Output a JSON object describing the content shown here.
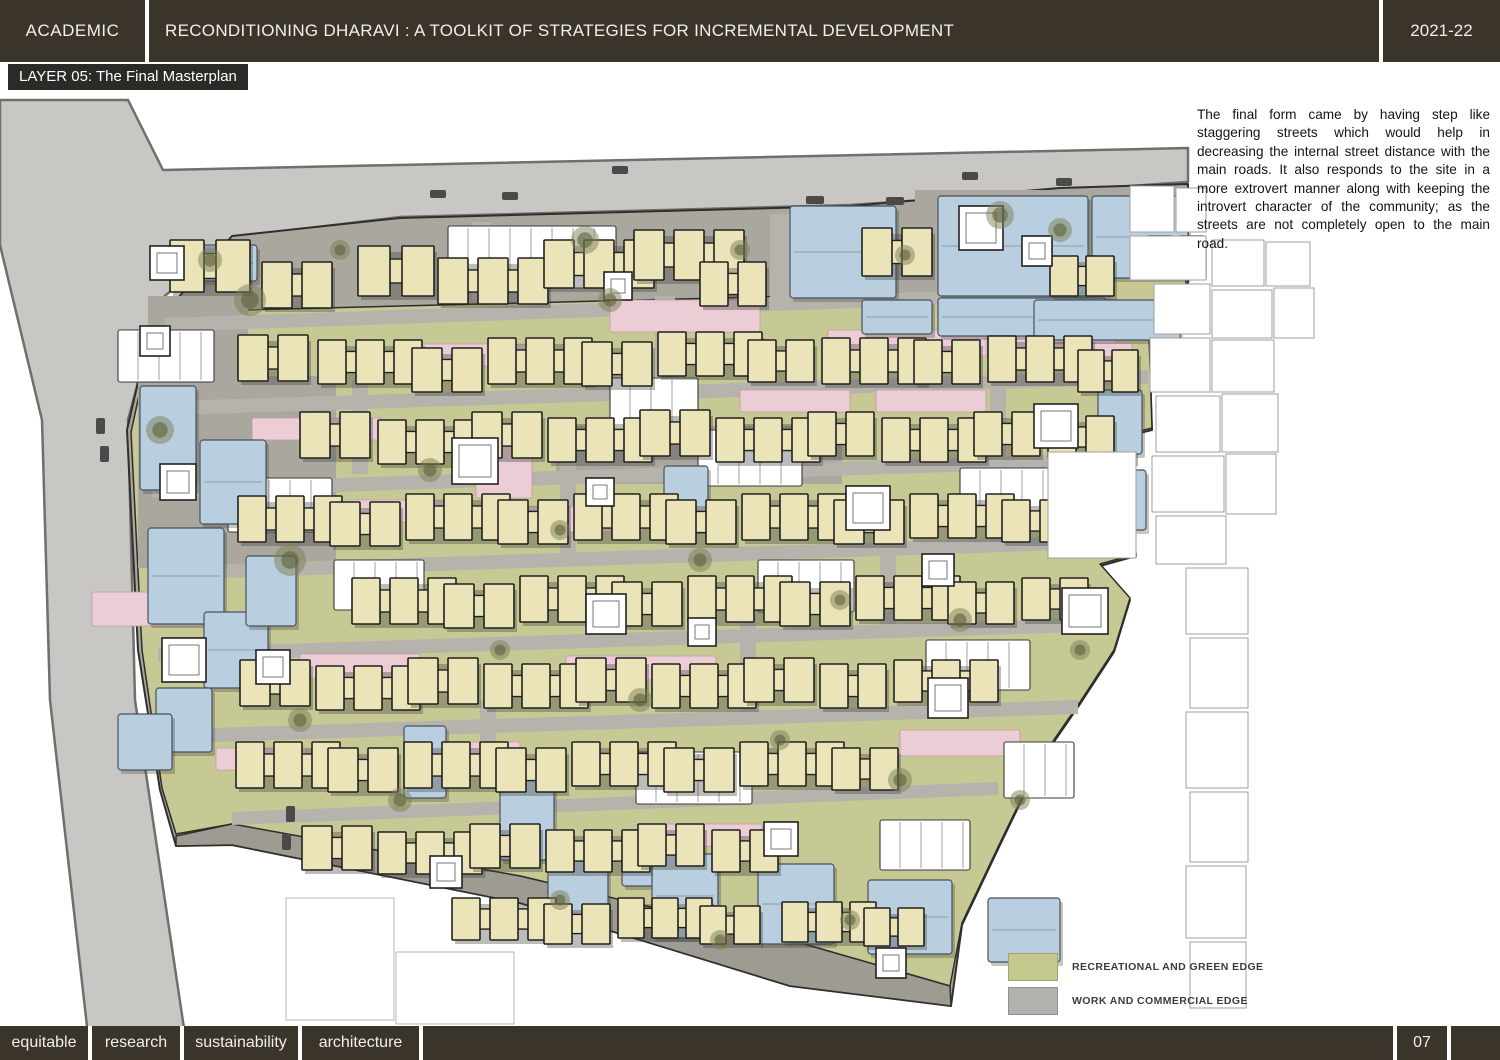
{
  "header": {
    "left": "ACADEMIC",
    "title": "RECONDITIONING DHARAVI : A TOOLKIT OF STRATEGIES FOR INCREMENTAL DEVELOPMENT",
    "right": "2021-22"
  },
  "layer_label": "LAYER 05: The Final Masterplan",
  "description": "The final form came by having step like staggering streets which would help in decreasing the internal street distance with the main roads. It also responds to the site in a more extrovert manner along with keeping the introvert character of the community; as the streets are not completely open to the main road.",
  "legend": {
    "items": [
      {
        "label": "RECREATIONAL AND GREEN EDGE",
        "color": "#c6c98d"
      },
      {
        "label": "WORK AND COMMERCIAL EDGE",
        "color": "#b2b1ad"
      }
    ]
  },
  "footer": {
    "tags": [
      "equitable",
      "research",
      "sustainability",
      "architecture"
    ],
    "page": "07"
  },
  "map": {
    "colors": {
      "road": "#c8c7c4",
      "roadEdge": "#6f6f6d",
      "siteGray": "#aaa79f",
      "siteEdge": "#2f2f2d",
      "bottomBand": "#9e9b93",
      "green": "#c7c995",
      "greenEdge": "#2c2c2a",
      "street": "#b6b3ac",
      "cream": "#ebe4b9",
      "creamEdge": "#22211e",
      "pink": "#eccdd6",
      "pinkEdge": "#c09aa6",
      "blue": "#b9cfe0",
      "blueEdge": "#46525c",
      "white": "#ffffff",
      "whiteEdge": "#3a3a3a",
      "context": "#9f9f9f",
      "contextLight": "#b8b8b8",
      "tree": "#7b7f53",
      "treeDark": "#5d6140",
      "car": "#4a4a48",
      "shadow": "#3f3e39"
    },
    "road_polygon": "0,100 128,100 163,170 1188,148 1188,182 850,205 400,217 235,237 160,300 128,420 135,700 185,1035 88,1035 50,700 42,420 0,245",
    "site_polygon": "232,236 400,218 850,206 1060,188 1188,184 1188,300 1148,308 1152,430 1120,438 1136,556 1100,566 1130,600 1114,652 1080,704 1040,762 1000,845 962,925 951,1006 790,986 520,903 232,845 176,846 160,790 138,650 127,430 150,330",
    "green_polygon": "165,312 1035,290 1038,215 1120,206 1186,202 1186,296 1148,304 1152,428 1120,436 1136,554 1100,564 1130,598 1114,650 1080,702 1040,760 1000,843 962,923 950,986 790,940 520,876 232,824 176,834 162,788 142,650 131,432 152,336",
    "bottom_band": "176,836 232,824 520,876 790,940 950,986 951,1006 790,986 520,903 232,845 176,846",
    "gray_plazas": [
      [
        138,
        376,
        198,
        192
      ],
      [
        915,
        190,
        196,
        112
      ],
      [
        148,
        296,
        100,
        110
      ],
      [
        556,
        426,
        286,
        58
      ]
    ],
    "streets": [
      [
        165,
        318,
        1035,
        288,
        14
      ],
      [
        142,
        402,
        1148,
        370,
        14
      ],
      [
        152,
        484,
        1138,
        452,
        14
      ],
      [
        166,
        566,
        1125,
        534,
        14
      ],
      [
        158,
        648,
        1108,
        617,
        14
      ],
      [
        152,
        730,
        1078,
        700,
        14
      ],
      [
        232,
        812,
        998,
        782,
        13
      ]
    ],
    "vstreets": [
      [
        472,
        222,
        18,
        80
      ],
      [
        655,
        296,
        20,
        94
      ],
      [
        770,
        214,
        22,
        96
      ],
      [
        352,
        380,
        16,
        94
      ],
      [
        560,
        462,
        16,
        94
      ],
      [
        880,
        534,
        16,
        98
      ],
      [
        740,
        617,
        16,
        94
      ],
      [
        480,
        700,
        16,
        86
      ],
      [
        900,
        296,
        18,
        80
      ],
      [
        990,
        380,
        16,
        86
      ]
    ],
    "green_patches": [
      [
        975,
        212,
        28,
        74
      ],
      [
        956,
        246,
        66,
        20
      ]
    ],
    "pinks": [
      [
        610,
        300,
        150,
        32
      ],
      [
        828,
        330,
        180,
        26
      ],
      [
        986,
        330,
        130,
        26
      ],
      [
        404,
        344,
        130,
        22
      ],
      [
        252,
        418,
        130,
        22
      ],
      [
        476,
        428,
        56,
        70
      ],
      [
        504,
        506,
        140,
        26
      ],
      [
        92,
        592,
        108,
        34
      ],
      [
        300,
        654,
        120,
        24
      ],
      [
        566,
        656,
        150,
        24
      ],
      [
        1082,
        343,
        50,
        40
      ],
      [
        740,
        390,
        110,
        22
      ],
      [
        876,
        390,
        110,
        22
      ],
      [
        348,
        500,
        100,
        22
      ],
      [
        900,
        730,
        120,
        26
      ],
      [
        216,
        748,
        90,
        22
      ],
      [
        652,
        824,
        110,
        22
      ],
      [
        420,
        742,
        100,
        22
      ]
    ],
    "whites": [
      [
        448,
        226,
        168,
        62
      ],
      [
        118,
        330,
        96,
        52
      ],
      [
        610,
        378,
        88,
        52
      ],
      [
        698,
        430,
        104,
        56
      ],
      [
        228,
        478,
        104,
        54
      ],
      [
        926,
        640,
        104,
        50
      ],
      [
        636,
        752,
        116,
        52
      ],
      [
        880,
        820,
        90,
        50
      ],
      [
        1004,
        742,
        70,
        56
      ],
      [
        334,
        560,
        90,
        50
      ],
      [
        758,
        560,
        96,
        52
      ],
      [
        960,
        468,
        90,
        52
      ]
    ],
    "blues": [
      [
        938,
        196,
        150,
        100
      ],
      [
        1092,
        196,
        96,
        82
      ],
      [
        938,
        298,
        168,
        38
      ],
      [
        1034,
        300,
        146,
        40
      ],
      [
        790,
        206,
        106,
        92
      ],
      [
        862,
        300,
        70,
        34
      ],
      [
        1098,
        390,
        44,
        64
      ],
      [
        1106,
        470,
        40,
        60
      ],
      [
        140,
        386,
        56,
        104
      ],
      [
        200,
        440,
        66,
        84
      ],
      [
        148,
        528,
        76,
        96
      ],
      [
        204,
        612,
        64,
        76
      ],
      [
        156,
        688,
        56,
        64
      ],
      [
        246,
        556,
        50,
        70
      ],
      [
        664,
        466,
        44,
        64
      ],
      [
        622,
        830,
        40,
        56
      ],
      [
        652,
        854,
        66,
        84
      ],
      [
        758,
        864,
        76,
        80
      ],
      [
        868,
        880,
        84,
        74
      ],
      [
        988,
        898,
        72,
        64
      ],
      [
        548,
        846,
        60,
        74
      ],
      [
        500,
        776,
        54,
        84
      ],
      [
        404,
        726,
        42,
        72
      ],
      [
        118,
        714,
        54,
        56
      ],
      [
        185,
        245,
        72,
        36
      ]
    ],
    "clusters": [
      [
        170,
        240,
        2,
        34,
        52,
        12
      ],
      [
        262,
        262,
        2,
        30,
        46,
        10
      ],
      [
        358,
        246,
        2,
        32,
        50,
        12
      ],
      [
        438,
        258,
        3,
        30,
        46,
        10
      ],
      [
        544,
        240,
        3,
        30,
        48,
        10
      ],
      [
        634,
        230,
        3,
        30,
        50,
        10
      ],
      [
        700,
        262,
        2,
        28,
        44,
        10
      ],
      [
        862,
        228,
        2,
        30,
        48,
        10
      ],
      [
        238,
        335,
        2,
        30,
        46,
        10
      ],
      [
        318,
        340,
        3,
        28,
        44,
        10
      ],
      [
        412,
        348,
        2,
        30,
        44,
        10
      ],
      [
        488,
        338,
        3,
        28,
        46,
        10
      ],
      [
        582,
        342,
        2,
        30,
        44,
        10
      ],
      [
        658,
        332,
        3,
        28,
        44,
        10
      ],
      [
        748,
        340,
        2,
        28,
        42,
        10
      ],
      [
        822,
        338,
        3,
        28,
        46,
        10
      ],
      [
        914,
        340,
        2,
        28,
        44,
        10
      ],
      [
        988,
        336,
        3,
        28,
        46,
        10
      ],
      [
        1078,
        350,
        2,
        26,
        42,
        8
      ],
      [
        300,
        412,
        2,
        30,
        46,
        10
      ],
      [
        378,
        420,
        3,
        28,
        44,
        10
      ],
      [
        472,
        412,
        2,
        30,
        46,
        10
      ],
      [
        548,
        418,
        3,
        28,
        44,
        10
      ],
      [
        640,
        410,
        2,
        30,
        46,
        10
      ],
      [
        716,
        418,
        3,
        28,
        44,
        10
      ],
      [
        808,
        412,
        2,
        28,
        44,
        10
      ],
      [
        882,
        418,
        3,
        28,
        44,
        10
      ],
      [
        974,
        412,
        2,
        28,
        44,
        10
      ],
      [
        1048,
        416,
        2,
        28,
        42,
        10
      ],
      [
        238,
        496,
        3,
        28,
        46,
        10
      ],
      [
        330,
        502,
        2,
        30,
        44,
        10
      ],
      [
        406,
        494,
        3,
        28,
        46,
        10
      ],
      [
        498,
        500,
        2,
        30,
        44,
        10
      ],
      [
        574,
        494,
        3,
        28,
        46,
        10
      ],
      [
        666,
        500,
        2,
        30,
        44,
        10
      ],
      [
        742,
        494,
        3,
        28,
        46,
        10
      ],
      [
        834,
        500,
        2,
        30,
        44,
        10
      ],
      [
        910,
        494,
        3,
        28,
        44,
        10
      ],
      [
        1002,
        500,
        2,
        28,
        42,
        10
      ],
      [
        352,
        578,
        3,
        28,
        46,
        10
      ],
      [
        444,
        584,
        2,
        30,
        44,
        10
      ],
      [
        520,
        576,
        3,
        28,
        46,
        10
      ],
      [
        612,
        582,
        2,
        30,
        44,
        10
      ],
      [
        688,
        576,
        3,
        28,
        46,
        10
      ],
      [
        780,
        582,
        2,
        30,
        44,
        10
      ],
      [
        856,
        576,
        3,
        28,
        44,
        10
      ],
      [
        948,
        582,
        2,
        28,
        42,
        10
      ],
      [
        1022,
        578,
        2,
        28,
        42,
        10
      ],
      [
        240,
        660,
        2,
        30,
        46,
        10
      ],
      [
        316,
        666,
        3,
        28,
        44,
        10
      ],
      [
        408,
        658,
        2,
        30,
        46,
        10
      ],
      [
        484,
        664,
        3,
        28,
        44,
        10
      ],
      [
        576,
        658,
        2,
        30,
        44,
        10
      ],
      [
        652,
        664,
        3,
        28,
        44,
        10
      ],
      [
        744,
        658,
        2,
        30,
        44,
        10
      ],
      [
        820,
        664,
        2,
        28,
        44,
        10
      ],
      [
        894,
        660,
        3,
        28,
        42,
        10
      ],
      [
        236,
        742,
        3,
        28,
        46,
        10
      ],
      [
        328,
        748,
        2,
        30,
        44,
        10
      ],
      [
        404,
        742,
        3,
        28,
        46,
        10
      ],
      [
        496,
        748,
        2,
        30,
        44,
        10
      ],
      [
        572,
        742,
        3,
        28,
        44,
        10
      ],
      [
        664,
        748,
        2,
        30,
        44,
        10
      ],
      [
        740,
        742,
        3,
        28,
        44,
        10
      ],
      [
        832,
        748,
        2,
        28,
        42,
        10
      ],
      [
        302,
        826,
        2,
        30,
        44,
        10
      ],
      [
        378,
        832,
        3,
        28,
        42,
        10
      ],
      [
        470,
        824,
        2,
        30,
        44,
        10
      ],
      [
        546,
        830,
        3,
        28,
        42,
        10
      ],
      [
        638,
        824,
        2,
        28,
        42,
        10
      ],
      [
        712,
        830,
        2,
        28,
        42,
        10
      ],
      [
        452,
        898,
        3,
        28,
        42,
        10
      ],
      [
        544,
        904,
        2,
        28,
        40,
        10
      ],
      [
        618,
        898,
        3,
        26,
        40,
        8
      ],
      [
        700,
        906,
        2,
        26,
        38,
        8
      ],
      [
        782,
        902,
        3,
        26,
        40,
        8
      ],
      [
        864,
        908,
        2,
        26,
        38,
        8
      ],
      [
        1050,
        256,
        2,
        28,
        40,
        8
      ],
      [
        1148,
        236,
        2,
        24,
        38,
        8
      ]
    ],
    "plazas": [
      [
        150,
        246,
        34
      ],
      [
        140,
        326,
        30
      ],
      [
        452,
        438,
        46
      ],
      [
        162,
        638,
        44
      ],
      [
        256,
        650,
        34
      ],
      [
        586,
        594,
        40
      ],
      [
        846,
        486,
        44
      ],
      [
        1034,
        404,
        44
      ],
      [
        922,
        554,
        32
      ],
      [
        688,
        618,
        28
      ],
      [
        928,
        678,
        40
      ],
      [
        764,
        822,
        34
      ],
      [
        586,
        478,
        28
      ],
      [
        1062,
        588,
        46
      ],
      [
        430,
        856,
        32
      ],
      [
        876,
        948,
        30
      ],
      [
        160,
        464,
        36
      ],
      [
        604,
        272,
        28
      ],
      [
        1022,
        236,
        30
      ],
      [
        959,
        206,
        44
      ]
    ],
    "trees": [
      [
        250,
        300,
        16
      ],
      [
        340,
        250,
        10
      ],
      [
        610,
        300,
        12
      ],
      [
        740,
        250,
        10
      ],
      [
        1000,
        215,
        14
      ],
      [
        1060,
        230,
        12
      ],
      [
        160,
        430,
        14
      ],
      [
        290,
        560,
        16
      ],
      [
        430,
        470,
        12
      ],
      [
        560,
        530,
        10
      ],
      [
        700,
        560,
        12
      ],
      [
        840,
        600,
        10
      ],
      [
        960,
        620,
        12
      ],
      [
        1080,
        650,
        10
      ],
      [
        300,
        720,
        12
      ],
      [
        500,
        650,
        10
      ],
      [
        640,
        700,
        12
      ],
      [
        780,
        740,
        10
      ],
      [
        900,
        780,
        12
      ],
      [
        1020,
        800,
        10
      ],
      [
        400,
        800,
        12
      ],
      [
        560,
        900,
        10
      ],
      [
        720,
        940,
        10
      ],
      [
        850,
        920,
        10
      ],
      [
        210,
        260,
        12
      ],
      [
        1105,
        545,
        10
      ],
      [
        585,
        240,
        14
      ],
      [
        905,
        255,
        10
      ]
    ],
    "context_right": [
      [
        1130,
        186,
        44,
        46
      ],
      [
        1176,
        188,
        30,
        44
      ],
      [
        1130,
        236,
        76,
        44
      ],
      [
        1212,
        240,
        52,
        46
      ],
      [
        1266,
        242,
        44,
        44
      ],
      [
        1154,
        284,
        56,
        50
      ],
      [
        1212,
        290,
        60,
        48
      ],
      [
        1274,
        288,
        40,
        50
      ],
      [
        1150,
        338,
        60,
        54
      ],
      [
        1212,
        340,
        62,
        52
      ],
      [
        1156,
        396,
        64,
        56
      ],
      [
        1222,
        394,
        56,
        58
      ],
      [
        1152,
        456,
        72,
        56
      ],
      [
        1226,
        454,
        50,
        60
      ],
      [
        1156,
        516,
        70,
        48
      ],
      [
        1186,
        568,
        62,
        66
      ],
      [
        1190,
        638,
        58,
        70
      ],
      [
        1186,
        712,
        62,
        76
      ],
      [
        1190,
        792,
        58,
        70
      ],
      [
        1186,
        866,
        60,
        72
      ],
      [
        1190,
        942,
        56,
        66
      ],
      [
        1048,
        452,
        88,
        106
      ]
    ],
    "context_bottom": [
      [
        286,
        898,
        108,
        122
      ],
      [
        396,
        952,
        118,
        72
      ]
    ],
    "cars": [
      [
        430,
        190,
        16,
        8
      ],
      [
        502,
        192,
        16,
        8
      ],
      [
        806,
        196,
        18,
        8
      ],
      [
        886,
        197,
        18,
        8
      ],
      [
        612,
        166,
        16,
        8
      ],
      [
        962,
        172,
        16,
        8
      ],
      [
        1056,
        178,
        16,
        8
      ],
      [
        96,
        418,
        9,
        16
      ],
      [
        100,
        446,
        9,
        16
      ],
      [
        286,
        806,
        9,
        16
      ],
      [
        282,
        834,
        9,
        16
      ]
    ]
  }
}
